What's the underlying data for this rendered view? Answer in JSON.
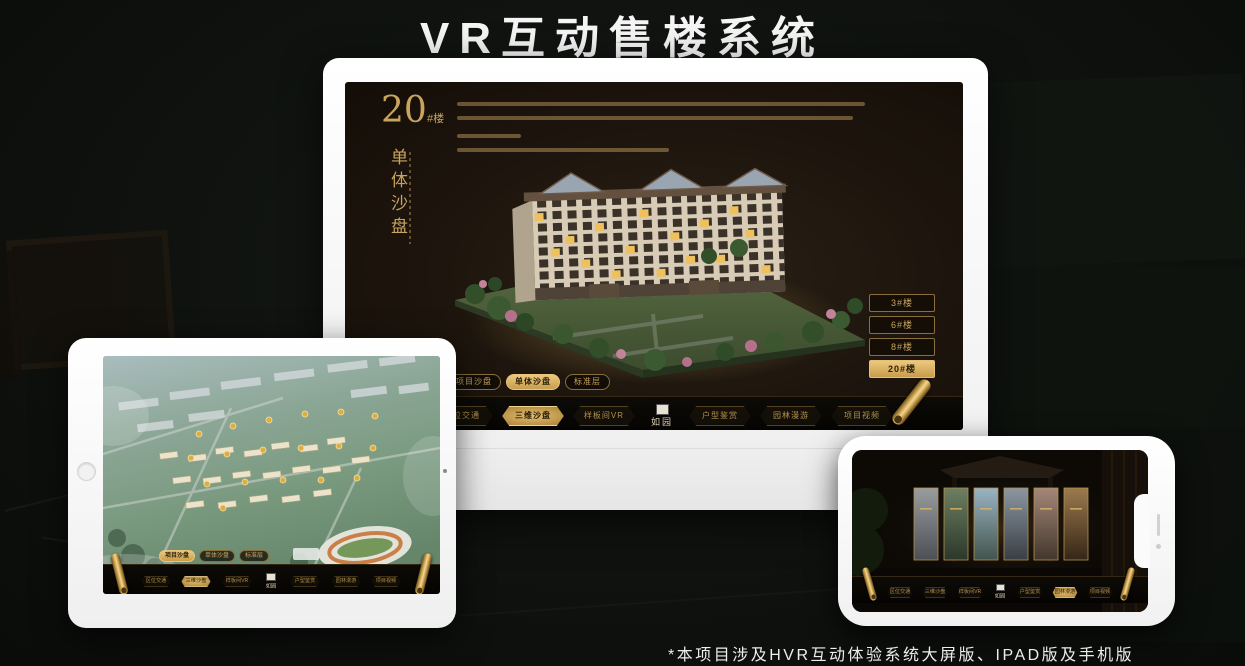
{
  "page": {
    "title": "VR互动售楼系统",
    "footnote": "*本项目涉及HVR互动体验系统大屏版、IPAD版及手机版"
  },
  "colors": {
    "accent_gold": "#c9a45e",
    "selected_gold": "#d9b367",
    "screen_background": "#1d150d",
    "title_white": "#f5f5f5"
  },
  "desktop": {
    "building_number": "20",
    "building_unit": "#楼",
    "panel_title": "单体沙盘",
    "floor_buttons": [
      {
        "label": "3#楼",
        "selected": false
      },
      {
        "label": "6#楼",
        "selected": false
      },
      {
        "label": "8#楼",
        "selected": false
      },
      {
        "label": "20#楼",
        "selected": true
      }
    ],
    "tabs": [
      {
        "label": "项目沙盘",
        "selected": false
      },
      {
        "label": "单体沙盘",
        "selected": true
      },
      {
        "label": "标准层",
        "selected": false
      }
    ],
    "menu": [
      {
        "label": "区位交通",
        "selected": false
      },
      {
        "label": "三维沙盘",
        "selected": true
      },
      {
        "label": "样板间VR",
        "selected": false
      },
      {
        "label": "户型鉴赏",
        "selected": false
      },
      {
        "label": "园林漫游",
        "selected": false
      },
      {
        "label": "项目视频",
        "selected": false
      }
    ],
    "logo": "如园"
  },
  "tablet": {
    "tabs": [
      {
        "label": "项目沙盘",
        "selected": true
      },
      {
        "label": "单体沙盘",
        "selected": false
      },
      {
        "label": "标准层",
        "selected": false
      }
    ],
    "menu": [
      {
        "label": "区位交通",
        "selected": false
      },
      {
        "label": "三维沙盘",
        "selected": true
      },
      {
        "label": "样板间VR",
        "selected": false
      },
      {
        "label": "户型鉴赏",
        "selected": false
      },
      {
        "label": "园林漫游",
        "selected": false
      },
      {
        "label": "项目视频",
        "selected": false
      }
    ],
    "logo": "如园"
  },
  "phone": {
    "menu": [
      {
        "label": "区位交通",
        "selected": false
      },
      {
        "label": "三维沙盘",
        "selected": false
      },
      {
        "label": "样板间VR",
        "selected": false
      },
      {
        "label": "户型鉴赏",
        "selected": false
      },
      {
        "label": "园林漫游",
        "selected": true
      },
      {
        "label": "项目视频",
        "selected": false
      }
    ],
    "logo": "如园"
  }
}
